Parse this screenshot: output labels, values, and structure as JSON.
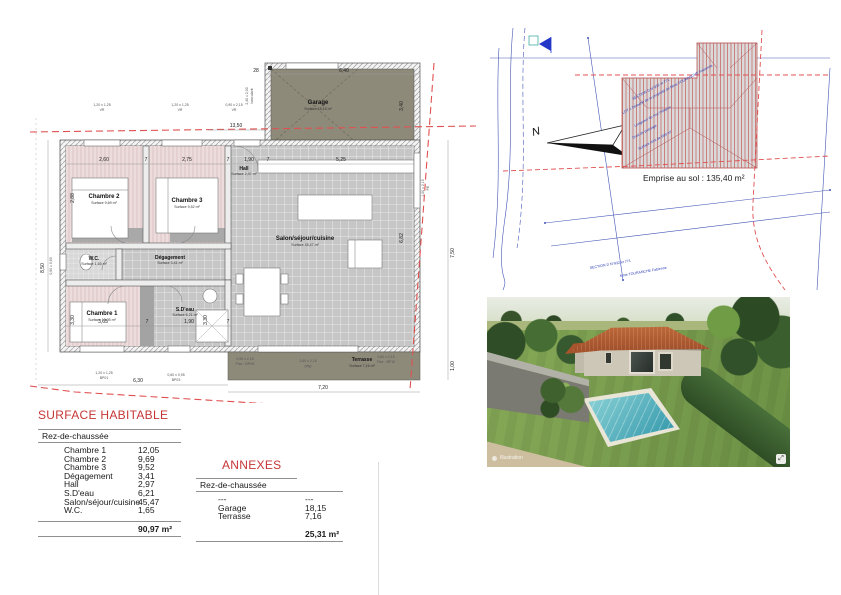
{
  "floor_plan": {
    "rooms": [
      {
        "name": "Garage",
        "surface": "Surface 18,15 m²"
      },
      {
        "name": "Chambre 2",
        "surface": "Surface 9,69 m²"
      },
      {
        "name": "Chambre 3",
        "surface": "Surface 9,52 m²"
      },
      {
        "name": "Hall",
        "surface": "Surface 2,97 m²"
      },
      {
        "name": "Salon/séjour/cuisine",
        "surface": "Surface 45,47 m²"
      },
      {
        "name": "W.C.",
        "surface": "Surface 1,65 m²"
      },
      {
        "name": "Dégagement",
        "surface": "Surface 3,41 m²"
      },
      {
        "name": "Chambre 1",
        "surface": "Surface 12,05 m²"
      },
      {
        "name": "S.D'eau",
        "surface": "Surface 6,21 m²"
      },
      {
        "name": "Terrasse",
        "surface": "Surface 7,16 m²"
      }
    ],
    "dims": [
      "2,60",
      "7",
      "2,75",
      "7",
      "1,90",
      "7",
      "5,25",
      "8,50",
      "2,88",
      "3,30",
      "3,65",
      "7",
      "1,90",
      "7",
      "3,30",
      "6,30",
      "7,20",
      "7,50",
      "1,00",
      "13,50",
      "28",
      "6,40",
      "3,40",
      "6,82"
    ],
    "openings": [
      {
        "size": "1,20 x 1,25",
        "type": "VR"
      },
      {
        "size": "1,20 x 1,25",
        "type": "VR"
      },
      {
        "size": "0,90 x 2,15",
        "type": "VR"
      },
      {
        "size": "2,40 x 2,00",
        "type": "basculant"
      },
      {
        "size": "1,20 x 1,25",
        "type": "BP01"
      },
      {
        "size": "0,60 x 0,95",
        "type": "BP03"
      },
      {
        "size": "0,60 x 0,60",
        "type": ""
      },
      {
        "size": "1,00 x 2,15",
        "type": "PE"
      },
      {
        "size": "0,90 x 2,15",
        "type": "Fixe - BPV8"
      },
      {
        "size": "3,60 x 2,15",
        "type": "(vtg)"
      },
      {
        "size": "0,60 x 2,15",
        "type": "Fixe - BP10"
      }
    ]
  },
  "site_plan": {
    "north_label": "N",
    "emprise_label": "Emprise au sol : 135,40 m²",
    "annotations": [
      "SECTION D N°932 et 771",
      "LOT 1 Détaché de la propriété de Mme TOURANCHE Fabienne",
      "Longueur du mur mitoyen",
      "Droit de passage",
      "Surface mini de 600 m²"
    ],
    "bottom_notes": [
      "SECTION D N°932 et 771",
      "Mme TOURANCHE Fabienne"
    ]
  },
  "surface_table": {
    "title": "SURFACE HABITABLE",
    "level": "Rez-de-chaussée",
    "rows": [
      {
        "label": "Chambre 1",
        "value": "12,05"
      },
      {
        "label": "Chambre 2",
        "value": "9,69"
      },
      {
        "label": "Chambre 3",
        "value": "9,52"
      },
      {
        "label": "Dégagement",
        "value": "3,41"
      },
      {
        "label": "Hall",
        "value": "2,97"
      },
      {
        "label": "S.D'eau",
        "value": "6,21"
      },
      {
        "label": "Salon/séjour/cuisine",
        "value": "45,47"
      },
      {
        "label": "W.C.",
        "value": "1,65"
      }
    ],
    "total": "90,97 m²"
  },
  "annexes_table": {
    "title": "ANNEXES",
    "level": "Rez-de-chaussée",
    "rows": [
      {
        "label": "---",
        "value": "---"
      },
      {
        "label": "Garage",
        "value": "18,15"
      },
      {
        "label": "Terrasse",
        "value": "7,16"
      }
    ],
    "total": "25,31 m²"
  },
  "render": {
    "watermark": "Illustration",
    "corner_badge": "⤢"
  }
}
